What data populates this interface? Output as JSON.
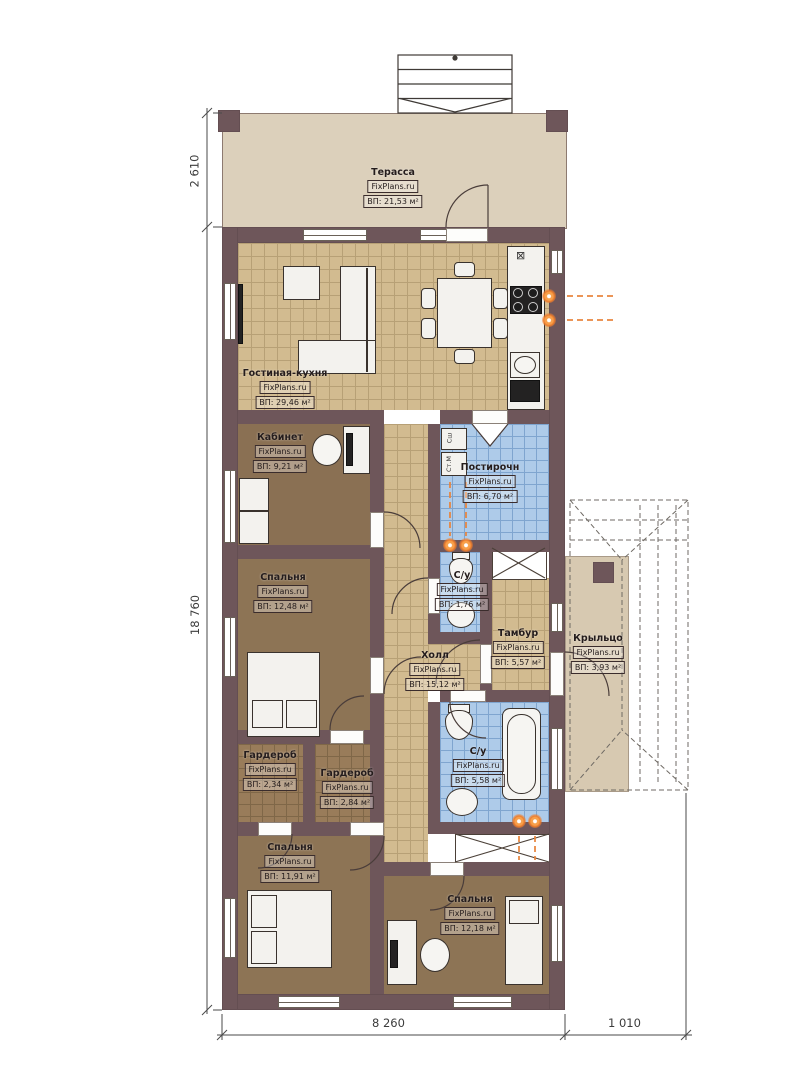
{
  "brand": "FixPlans.ru",
  "rooms": {
    "terrace": {
      "name": "Терасса",
      "area": "ВП: 21,53 м²"
    },
    "living": {
      "name": "Гостиная-кухня",
      "area": "ВП: 29,46 м²"
    },
    "office": {
      "name": "Кабинет",
      "area": "ВП: 9,21 м²"
    },
    "laundry": {
      "name": "Постирочн",
      "area": "ВП: 6,70 м²"
    },
    "bedroom1": {
      "name": "Спальня",
      "area": "ВП: 12,48 м²"
    },
    "wc1": {
      "name": "С/у",
      "area": "ВП: 1,76 м²"
    },
    "hall": {
      "name": "Холл",
      "area": "ВП: 15,12 м²"
    },
    "tambour": {
      "name": "Тамбур",
      "area": "ВП: 5,57 м²"
    },
    "porch": {
      "name": "Крыльцо",
      "area": "ВП: 3,93 м²"
    },
    "wardrobe1": {
      "name": "Гардероб",
      "area": "ВП: 2,34 м²"
    },
    "wardrobe2": {
      "name": "Гардероб",
      "area": "ВП: 2,84 м²"
    },
    "wc2": {
      "name": "С/у",
      "area": "ВП: 5,58 м²"
    },
    "bedroom2": {
      "name": "Спальня",
      "area": "ВП: 11,91 м²"
    },
    "bedroom3": {
      "name": "Спальня",
      "area": "ВП: 12,18 м²"
    }
  },
  "appliances": {
    "dryer": "Сш",
    "washer": "Ст.М"
  },
  "dimensions": {
    "terrace_depth": "2 610",
    "house_length": "18 760",
    "house_width": "8 260",
    "porch_width": "1 010"
  },
  "colors": {
    "wall": "#6e565a",
    "tile_tan": "#d2bb90",
    "tile_blue": "#aecbe9",
    "carpet": "#8d7455",
    "terrace": "#dcd0bb",
    "porch": "#d7c9b1",
    "flame": "#ee7d2c"
  }
}
